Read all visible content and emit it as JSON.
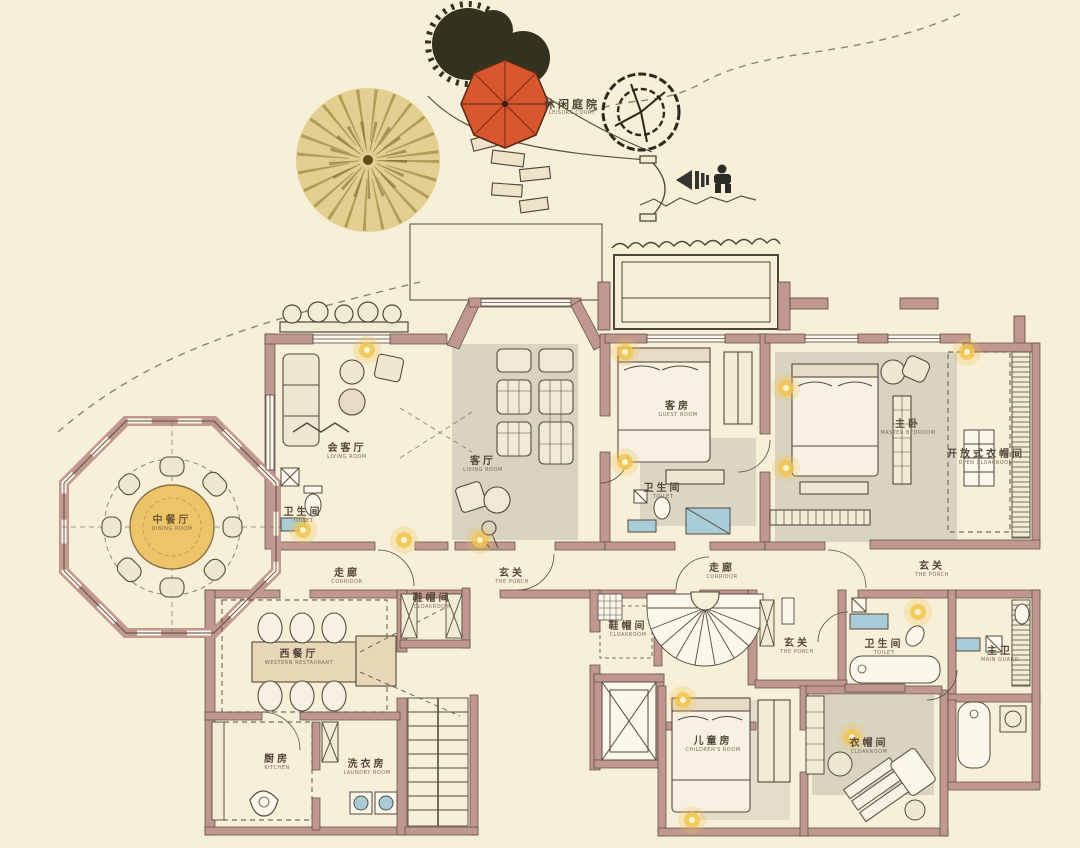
{
  "title": "Residence floor plan with leisure court",
  "colors": {
    "background": "#f7efd8",
    "wall": "#c0988f",
    "line_dark": "#4f463b",
    "accent_lamp_yellow": "#f2c44c",
    "umbrella_orange": "#d9572e",
    "fixture_blue": "#a9cdd8",
    "rug_gray": "#d9d3c1",
    "table_yellow": "#eec468",
    "foliage_dark": "#33311f",
    "foliage_yellow": "#c9a93e",
    "furniture_cream": "#efe7d2"
  },
  "entry": {
    "marker": "entrance-arrow-with-person"
  },
  "plan": {
    "rooms": [
      {
        "id": "leisure-court",
        "zh": "休闲庭院",
        "en": "LEISURE COURT"
      },
      {
        "id": "dining",
        "zh": "中餐厅",
        "en": "DINING ROOM"
      },
      {
        "id": "reception",
        "zh": "会客厅",
        "en": "LIVING ROOM"
      },
      {
        "id": "toilet-reception",
        "zh": "卫生间",
        "en": "TOILET"
      },
      {
        "id": "living",
        "zh": "客厅",
        "en": "LIVING ROOM"
      },
      {
        "id": "guest",
        "zh": "客房",
        "en": "GUEST ROOM"
      },
      {
        "id": "toilet-guest",
        "zh": "卫生间",
        "en": "TOILET"
      },
      {
        "id": "master",
        "zh": "主卧",
        "en": "MASTER BEDROOM"
      },
      {
        "id": "open-cloak",
        "zh": "开放式衣帽间",
        "en": "OPEN CLOAKROOM"
      },
      {
        "id": "corridor-left",
        "zh": "走廊",
        "en": "CORRIDOR"
      },
      {
        "id": "porch-center",
        "zh": "玄关",
        "en": "THE PORCH"
      },
      {
        "id": "corridor-right",
        "zh": "走廊",
        "en": "CORRIDOR"
      },
      {
        "id": "porch-right",
        "zh": "玄关",
        "en": "THE PORCH"
      },
      {
        "id": "cloak-small-1",
        "zh": "鞋帽间",
        "en": "CLOAKROOM"
      },
      {
        "id": "cloak-small-2",
        "zh": "鞋帽间",
        "en": "CLOAKROOM"
      },
      {
        "id": "western",
        "zh": "西餐厅",
        "en": "WESTERN RESTAURANT"
      },
      {
        "id": "kitchen",
        "zh": "厨房",
        "en": "KITCHEN"
      },
      {
        "id": "laundry",
        "zh": "洗衣房",
        "en": "LAUNDRY ROOM"
      },
      {
        "id": "porch-lower",
        "zh": "玄关",
        "en": "THE PORCH"
      },
      {
        "id": "toilet-lower",
        "zh": "卫生间",
        "en": "TOILET"
      },
      {
        "id": "main-guard",
        "zh": "主卫",
        "en": "MAIN GUARD"
      },
      {
        "id": "children",
        "zh": "儿童房",
        "en": "CHILDREN'S ROOM"
      },
      {
        "id": "cloak-lower",
        "zh": "衣帽间",
        "en": "CLOAKROOM"
      }
    ]
  }
}
